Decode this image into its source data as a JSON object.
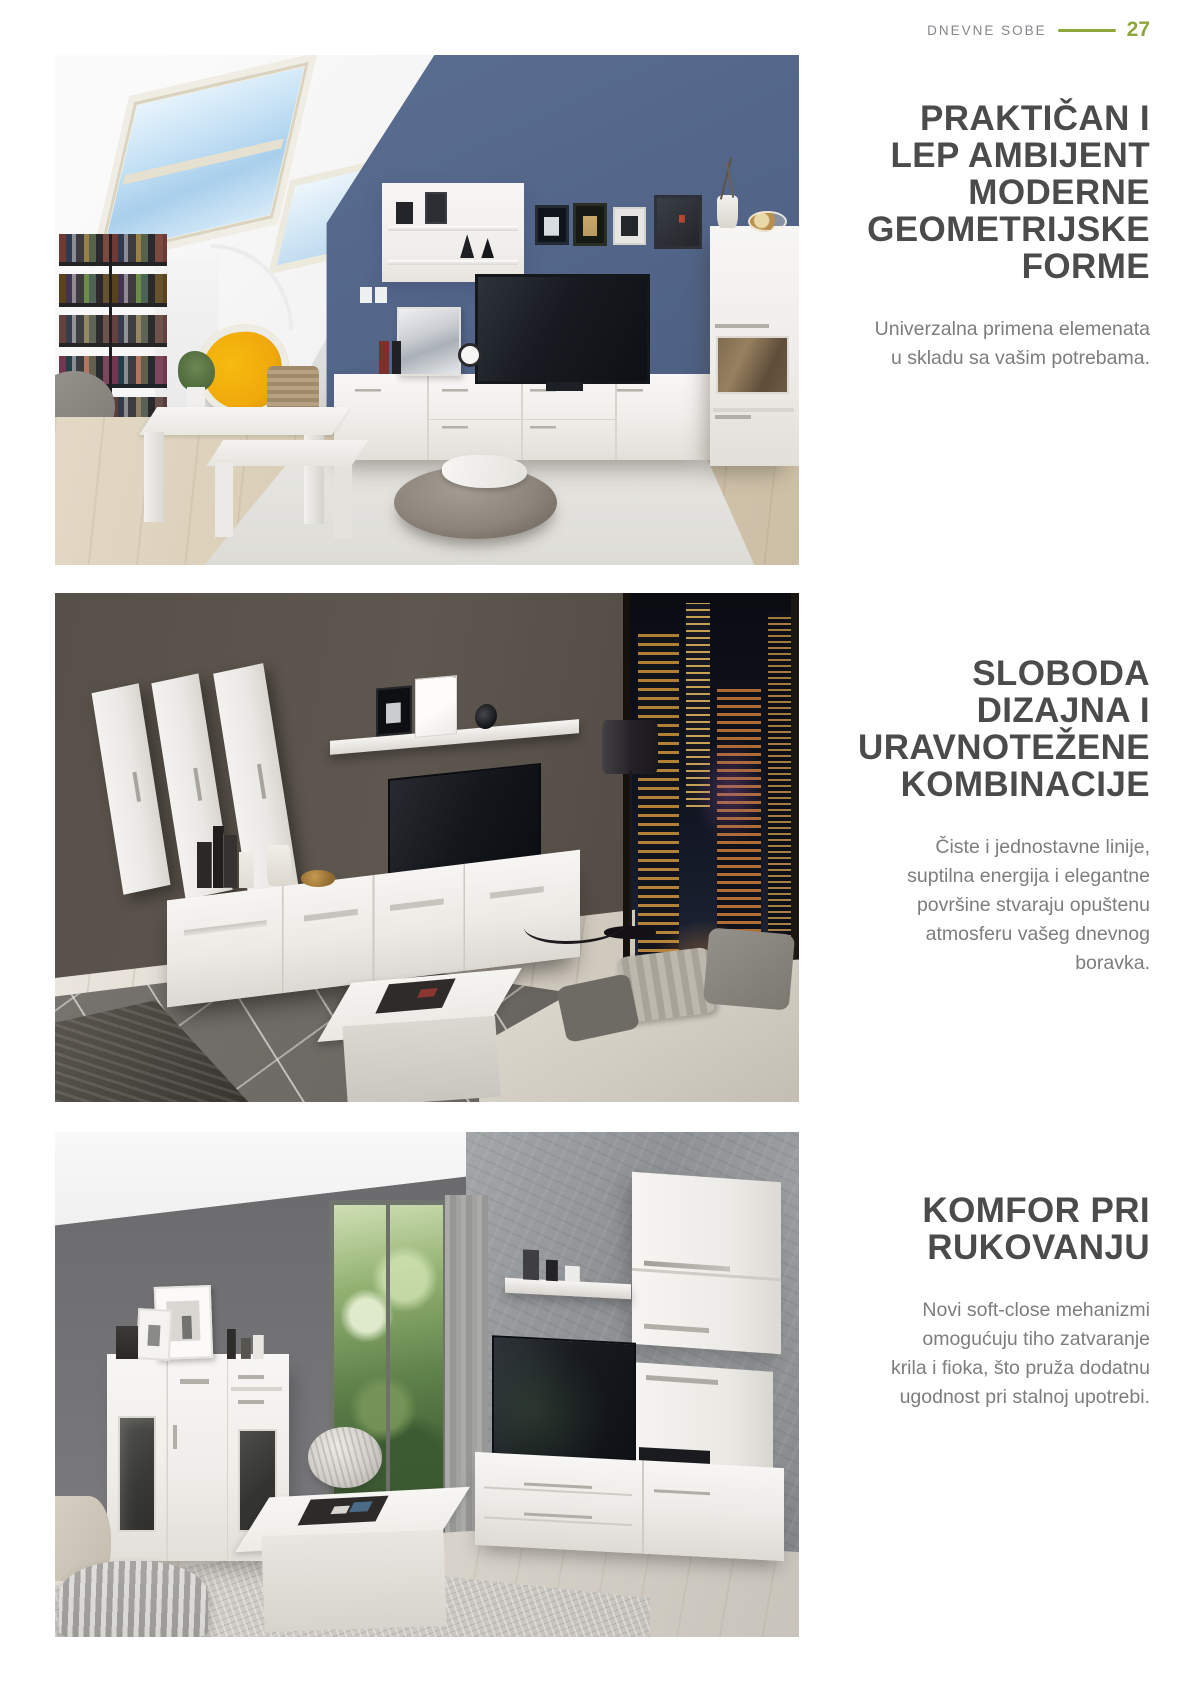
{
  "theme": {
    "accent_green": "#8fa63d",
    "heading_color": "#4b4b4c",
    "body_text_color": "#7d7d7e",
    "header_label_color": "#84878b",
    "page_background": "#ffffff"
  },
  "header": {
    "section_label": "DNEVNE SOBE",
    "page_number": "27"
  },
  "sections": [
    {
      "heading_text": "PRAKTIČAN I LEP AMBIJENT MODERNE GEOMETRIJSKE FORME",
      "heading_lines": [
        "PRAKTIČAN I",
        "LEP AMBIJENT",
        "MODERNE",
        "GEOMETRIJSKE",
        "FORME"
      ],
      "body_text": "Univerzalna primena elemenata u skladu sa vašim potrebama.",
      "body_lines": [
        "Univerzalna primena elemenata",
        "u skladu sa vašim potrebama."
      ],
      "photo": {
        "name": "attic-living-room",
        "description": "Attic living room with skylights, blue accent wall, white TV wall unit, bookshelf, yellow chair, nesting tables and gray pouf"
      }
    },
    {
      "heading_text": "SLOBODA DIZAJNA I URAVNOTEŽENE KOMBINACIJE",
      "heading_lines": [
        "SLOBODA",
        "DIZAJNA I",
        "URAVNOTEŽENE",
        "KOMBINACIJE"
      ],
      "body_text": "Čiste i jednostavne linije, suptilna energija i elegantne površine stvaraju opuštenu atmosferu vašeg dnevnog boravka.",
      "body_lines": [
        "Čiste i jednostavne linije,",
        "suptilna energija i elegantne",
        "površine stvaraju opuštenu",
        "atmosferu vašeg dnevnog",
        "boravka."
      ],
      "photo": {
        "name": "night-city-living-room",
        "description": "Dark living room with white hanging cabinets, wall shelf, TV bench, floor lamp, geometric rug and window with night city view"
      }
    },
    {
      "heading_text": "KOMFOR PRI RUKOVANJU",
      "heading_lines": [
        "KOMFOR PRI",
        "RUKOVANJU"
      ],
      "body_text": "Novi soft-close mehanizmi omogućuju tiho zatvaranje krila i fioka, što pruža dodatnu ugodnost pri stalnoj upotrebi.",
      "body_lines": [
        "Novi soft-close mehanizmi",
        "omogućuju tiho zatvaranje",
        "krila i fioka, što pruža dodatnu",
        "ugodnost pri stalnoj upotrebi."
      ],
      "photo": {
        "name": "gray-living-room",
        "description": "Living room with gray walls, garden window, white highboard, wall cabinets, TV bench and white coffee table"
      }
    }
  ]
}
